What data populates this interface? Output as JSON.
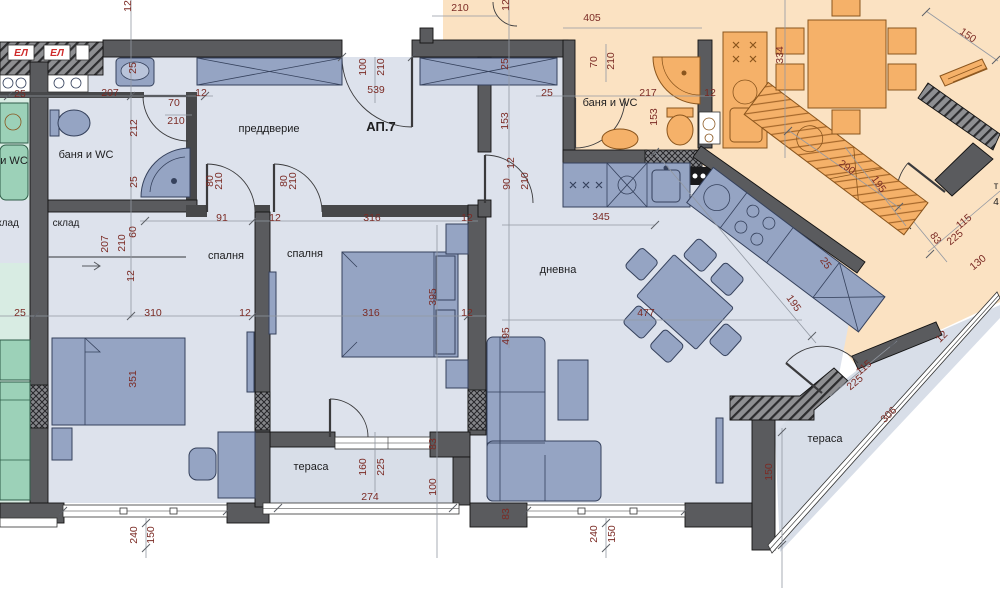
{
  "plan": {
    "apartment_title": "АП.7",
    "drawing_type": "apartment floor plan"
  },
  "colors": {
    "wall": "#5a5b5e",
    "main_floor": "#dde2ec",
    "terrace_floor": "#d8dee8",
    "neighbor_orange_floor": "#fbe2c2",
    "neighbor_orange_furniture": "#f5b169",
    "neighbor_teal_floor": "#d8ece3",
    "neighbor_teal_furniture": "#9cd1b8",
    "blue_furniture": "#95a4c3",
    "dimension_text": "#7b2b25",
    "label_text": "#1d1d1f",
    "el_panel_red": "#cf2b2b"
  },
  "el_panels": [
    "ЕЛ",
    "ЕЛ"
  ],
  "room_labels": [
    {
      "text": "АП.7",
      "x": 381,
      "y": 131,
      "size": 13,
      "bold": true
    },
    {
      "text": "преддверие",
      "x": 269,
      "y": 132,
      "size": 11,
      "bold": false
    },
    {
      "text": "баня и WC",
      "x": 86,
      "y": 158,
      "size": 11,
      "bold": false
    },
    {
      "text": "баня и WC",
      "x": 610,
      "y": 106,
      "size": 11,
      "bold": false
    },
    {
      "text": "склад",
      "x": 66,
      "y": 226,
      "size": 10,
      "bold": false
    },
    {
      "text": "клад",
      "x": 8,
      "y": 226,
      "size": 10,
      "bold": false
    },
    {
      "text": "и WC",
      "x": 14,
      "y": 164,
      "size": 11,
      "bold": false
    },
    {
      "text": "спалня",
      "x": 226,
      "y": 259,
      "size": 11,
      "bold": false
    },
    {
      "text": "спалня",
      "x": 305,
      "y": 257,
      "size": 11,
      "bold": false
    },
    {
      "text": "дневна",
      "x": 558,
      "y": 273,
      "size": 11,
      "bold": false
    },
    {
      "text": "тераса",
      "x": 311,
      "y": 470,
      "size": 11,
      "bold": false
    },
    {
      "text": "тераса",
      "x": 825,
      "y": 442,
      "size": 11,
      "bold": false
    },
    {
      "text": "т",
      "x": 996,
      "y": 189,
      "size": 10,
      "bold": false
    },
    {
      "text": "4",
      "x": 996,
      "y": 205,
      "size": 10,
      "bold": false
    }
  ],
  "dims": [
    {
      "t": "12",
      "x": 131,
      "y": 6,
      "r": -90
    },
    {
      "t": "25",
      "x": 20,
      "y": 97,
      "r": 0
    },
    {
      "t": "207",
      "x": 110,
      "y": 96,
      "r": 0
    },
    {
      "t": "25",
      "x": 136,
      "y": 68,
      "r": -90
    },
    {
      "t": "70",
      "x": 174,
      "y": 106,
      "r": 0
    },
    {
      "t": "210",
      "x": 176,
      "y": 124,
      "r": 0
    },
    {
      "t": "212",
      "x": 137,
      "y": 128,
      "r": -90
    },
    {
      "t": "25",
      "x": 137,
      "y": 182,
      "r": -90
    },
    {
      "t": "207",
      "x": 108,
      "y": 244,
      "r": -90
    },
    {
      "t": "210",
      "x": 125,
      "y": 243,
      "r": -90
    },
    {
      "t": "60",
      "x": 136,
      "y": 232,
      "r": -90
    },
    {
      "t": "12",
      "x": 134,
      "y": 276,
      "r": -90
    },
    {
      "t": "25",
      "x": 20,
      "y": 316,
      "r": 0
    },
    {
      "t": "310",
      "x": 153,
      "y": 316,
      "r": 0
    },
    {
      "t": "351",
      "x": 136,
      "y": 379,
      "r": -90
    },
    {
      "t": "80",
      "x": 213,
      "y": 181,
      "r": -90
    },
    {
      "t": "210",
      "x": 222,
      "y": 181,
      "r": -90
    },
    {
      "t": "80",
      "x": 287,
      "y": 181,
      "r": -90
    },
    {
      "t": "210",
      "x": 296,
      "y": 181,
      "r": -90
    },
    {
      "t": "91",
      "x": 222,
      "y": 221,
      "r": 0
    },
    {
      "t": "12",
      "x": 275,
      "y": 221,
      "r": 0
    },
    {
      "t": "316",
      "x": 372,
      "y": 221,
      "r": 0
    },
    {
      "t": "12",
      "x": 467,
      "y": 221,
      "r": 0
    },
    {
      "t": "12",
      "x": 245,
      "y": 316,
      "r": 0
    },
    {
      "t": "316",
      "x": 371,
      "y": 316,
      "r": 0
    },
    {
      "t": "12",
      "x": 467,
      "y": 316,
      "r": 0
    },
    {
      "t": "395",
      "x": 436,
      "y": 297,
      "r": -90
    },
    {
      "t": "100",
      "x": 366,
      "y": 67,
      "r": -90
    },
    {
      "t": "210",
      "x": 384,
      "y": 67,
      "r": -90
    },
    {
      "t": "539",
      "x": 376,
      "y": 93,
      "r": 0
    },
    {
      "t": "12",
      "x": 201,
      "y": 96,
      "r": 0
    },
    {
      "t": "25",
      "x": 508,
      "y": 64,
      "r": -90
    },
    {
      "t": "153",
      "x": 508,
      "y": 121,
      "r": -90
    },
    {
      "t": "25",
      "x": 547,
      "y": 96,
      "r": 0
    },
    {
      "t": "90",
      "x": 510,
      "y": 184,
      "r": -90
    },
    {
      "t": "12",
      "x": 514,
      "y": 163,
      "r": -90
    },
    {
      "t": "210",
      "x": 528,
      "y": 181,
      "r": -90
    },
    {
      "t": "210",
      "x": 460,
      "y": 11,
      "r": 0
    },
    {
      "t": "12",
      "x": 509,
      "y": 5,
      "r": -90
    },
    {
      "t": "405",
      "x": 592,
      "y": 21,
      "r": 0
    },
    {
      "t": "70",
      "x": 597,
      "y": 62,
      "r": -90
    },
    {
      "t": "210",
      "x": 614,
      "y": 61,
      "r": -90
    },
    {
      "t": "217",
      "x": 648,
      "y": 96,
      "r": 0
    },
    {
      "t": "153",
      "x": 657,
      "y": 117,
      "r": -90
    },
    {
      "t": "12",
      "x": 710,
      "y": 96,
      "r": 0
    },
    {
      "t": "334",
      "x": 783,
      "y": 55,
      "r": -90
    },
    {
      "t": "150",
      "x": 966,
      "y": 38,
      "r": 35
    },
    {
      "t": "290",
      "x": 845,
      "y": 170,
      "r": 35
    },
    {
      "t": "195",
      "x": 876,
      "y": 186,
      "r": 55
    },
    {
      "t": "115",
      "x": 966,
      "y": 224,
      "r": -40
    },
    {
      "t": "225",
      "x": 957,
      "y": 240,
      "r": -40
    },
    {
      "t": "130",
      "x": 980,
      "y": 265,
      "r": -40
    },
    {
      "t": "83",
      "x": 933,
      "y": 240,
      "r": 55
    },
    {
      "t": "345",
      "x": 601,
      "y": 220,
      "r": 0
    },
    {
      "t": "477",
      "x": 646,
      "y": 316,
      "r": 0
    },
    {
      "t": "495",
      "x": 509,
      "y": 336,
      "r": -90
    },
    {
      "t": "195",
      "x": 791,
      "y": 305,
      "r": 55
    },
    {
      "t": "25",
      "x": 823,
      "y": 265,
      "r": 55
    },
    {
      "t": "160",
      "x": 366,
      "y": 467,
      "r": -90
    },
    {
      "t": "225",
      "x": 384,
      "y": 467,
      "r": -90
    },
    {
      "t": "274",
      "x": 370,
      "y": 500,
      "r": 0
    },
    {
      "t": "100",
      "x": 436,
      "y": 487,
      "r": -90
    },
    {
      "t": "83",
      "x": 436,
      "y": 444,
      "r": -90
    },
    {
      "t": "83",
      "x": 509,
      "y": 514,
      "r": -90
    },
    {
      "t": "240",
      "x": 137,
      "y": 535,
      "r": -90
    },
    {
      "t": "150",
      "x": 154,
      "y": 535,
      "r": -90
    },
    {
      "t": "240",
      "x": 597,
      "y": 534,
      "r": -90
    },
    {
      "t": "150",
      "x": 615,
      "y": 534,
      "r": -90
    },
    {
      "t": "115",
      "x": 866,
      "y": 370,
      "r": -40
    },
    {
      "t": "225",
      "x": 857,
      "y": 385,
      "r": -40
    },
    {
      "t": "306",
      "x": 891,
      "y": 417,
      "r": -45
    },
    {
      "t": "150",
      "x": 772,
      "y": 472,
      "r": -90
    },
    {
      "t": "12",
      "x": 944,
      "y": 339,
      "r": -45
    }
  ]
}
